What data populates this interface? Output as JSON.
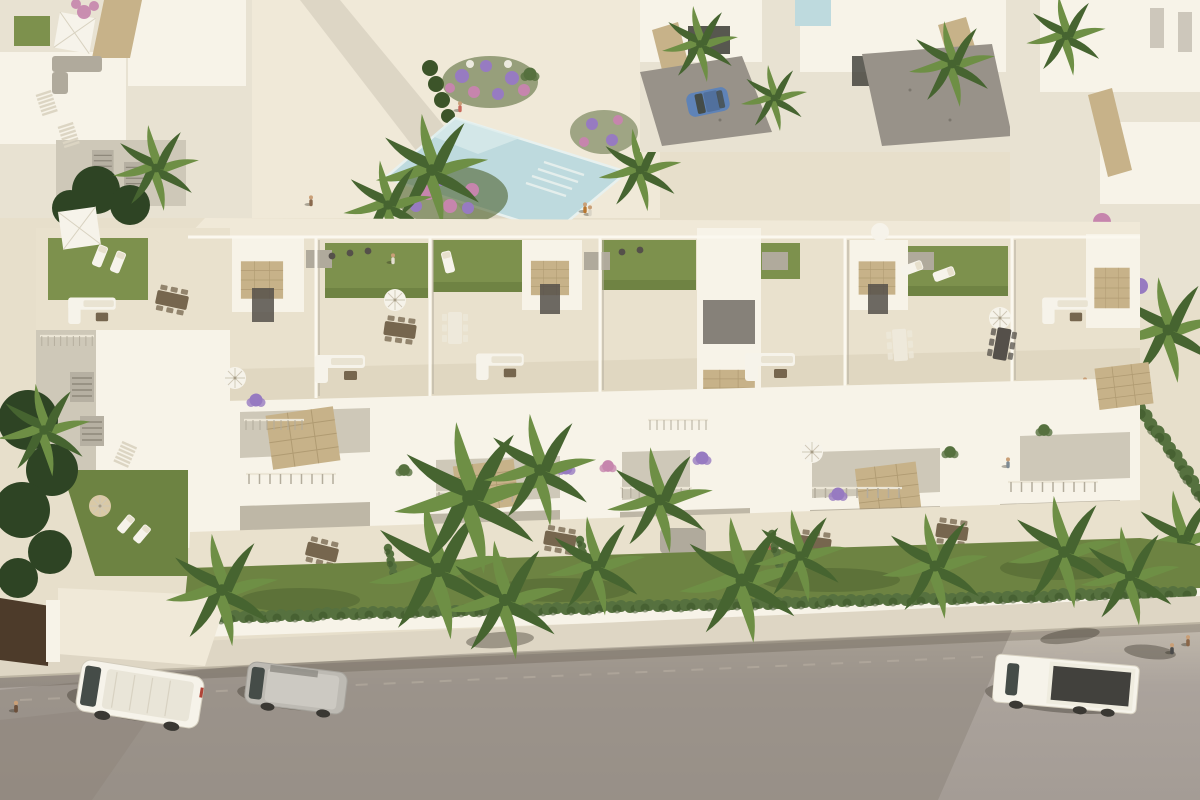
{
  "scene": {
    "type": "aerial-architectural-render",
    "description": "Aerial 3D render of a Mediterranean residential complex: a long row of white townhouses with rooftop terraces and green roof gardens, balconies with planters, private gardens with palm trees and a hedge behind a white boundary wall, a communal pool plaza and detached villas behind, and a street in front with a white van, a grey van and a white flatbed truck.",
    "lighting": "low warm sun from the upper right casting long shadows toward the lower left",
    "objects": {
      "buildings": [
        "townhouse-row",
        "left-corner-block",
        "rear-townhouse-row",
        "detached-villas"
      ],
      "amenities": [
        "communal-pool",
        "roof-lawns",
        "roof-terraces",
        "balconies",
        "ground-terraces",
        "private-gardens"
      ],
      "furniture": [
        "white-parasols",
        "dining-sets",
        "white-lounge-sofas",
        "sun-loungers",
        "daybed"
      ],
      "vegetation": [
        "palm-trees",
        "hedge-row",
        "lawns",
        "flower-beds",
        "bougainvillea"
      ],
      "vehicles": [
        "white-van",
        "grey-van",
        "white-flatbed-truck",
        "blue-hatchback"
      ],
      "street": [
        "asphalt-road",
        "sidewalk",
        "white-boundary-wall",
        "driveway-apron",
        "dark-gate"
      ],
      "people": [
        "pool-deck-walkers",
        "roof-terrace-residents",
        "balcony-residents",
        "sidewalk-pedestrians"
      ]
    }
  },
  "palette": {
    "paving": "#e7dfcb",
    "pavingLight": "#f0e9d8",
    "pavingShade": "#cfc6b0",
    "wallLit": "#f7f3e8",
    "wallMid": "#e8e2d2",
    "wallShade": "#cec8b8",
    "wallDark": "#b0aa9c",
    "stone": "#c7b289",
    "stoneDark": "#a18c64",
    "tile": "#e9e1cd",
    "tileShade": "#d8cfb8",
    "lawnRoof": "#7d914d",
    "lawnRoofDark": "#62763a",
    "lawnGround": "#6d8342",
    "lawnGroundDark": "#4e622f",
    "hedge": "#56713f",
    "hedgeDark": "#3c5429",
    "palmLight": "#6e8f45",
    "palmDark": "#466430",
    "treeDark": "#2e4424",
    "pool": "#bedade",
    "poolLight": "#dcecec",
    "road": "#a8a099",
    "roadLit": "#c1b9ac",
    "roadShadow": "#8b8379",
    "sidewalk": "#ded6c4",
    "gravel": "#989289",
    "furnWhite": "#f6f3ea",
    "furnDark": "#55504a",
    "furnBrown": "#76664e",
    "glass": "#454c48",
    "carBlue": "#5f83b7",
    "truckBed": "#42413d",
    "flowerPurple": "#977bc1",
    "flowerPink": "#c685ad",
    "skin": "#c99f77",
    "shadow": "rgba(52,48,36,0.38)",
    "gate": "#4d3b2a"
  }
}
